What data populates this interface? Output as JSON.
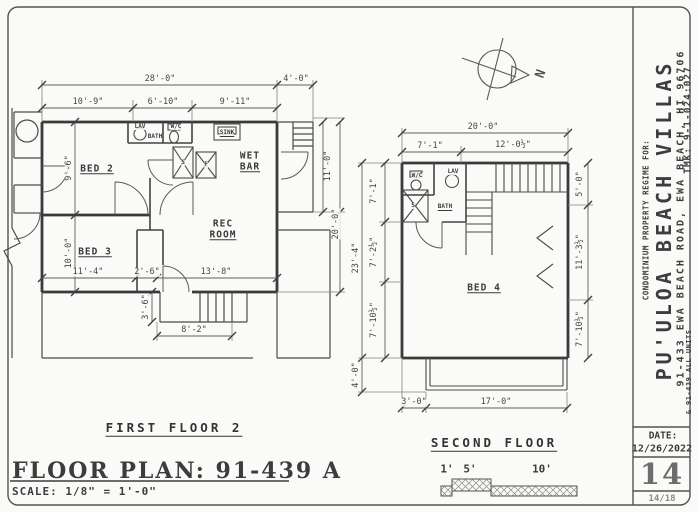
{
  "sheet": {
    "title_block": {
      "regime_line": "CONDOMINIUM PROPERTY REGIME FOR:",
      "project_name": "PU'ULOA BEACH VILLAS",
      "address": "91-433 EWA BEACH ROAD, EWA BEACH, HI 96706",
      "units_line": "& 91-439 ALL UNITS",
      "tmk": "TMK: 9-1-024:027",
      "date_label": "DATE:",
      "date_value": "12/26/2022",
      "sheet_number": "14",
      "page_fraction": "14/18"
    },
    "footer": {
      "plan_title": "FLOOR PLAN: 91-439 A",
      "scale_note": "SCALE: 1/8\" = 1'-0\""
    },
    "scale_bar": {
      "tick_1": "1'",
      "tick_5": "5'",
      "tick_10": "10'"
    },
    "north_label": "N"
  },
  "first_floor": {
    "caption": "FIRST FLOOR 2",
    "dims": {
      "overall_width": "28'-0\"",
      "right_ext": "4'-0\"",
      "top_a": "10'-9\"",
      "top_b": "6'-10\"",
      "top_c": "9'-11\"",
      "bed2_depth": "9'-6\"",
      "bed3_depth": "10'-0\"",
      "right_upper": "11'-0\"",
      "right_overall": "20'-0\"",
      "bottom_a": "11'-4\"",
      "bottom_b": "2'-6\"",
      "bottom_c": "13'-8\"",
      "stoop_depth": "3'-6\"",
      "stoop_width": "8'-2\""
    },
    "labels": {
      "bed2": "BED 2",
      "bed3": "BED 3",
      "rec_line1": "REC",
      "rec_line2": "ROOM",
      "wetbar_line1": "WET",
      "wetbar_line2": "BAR",
      "bath": "BATH",
      "lav": "LAV",
      "wc": "W/C",
      "sink": "SINK",
      "shower": "S",
      "closet_f": "F"
    }
  },
  "second_floor": {
    "caption": "SECOND FLOOR",
    "dims": {
      "overall_width": "20'-0\"",
      "top_a": "7'-1\"",
      "top_b": "12'-0½\"",
      "overall_depth": "23'-4\"",
      "left_a": "7'-1\"",
      "left_b": "7'-2½\"",
      "left_c": "7'-10½\"",
      "deck_depth": "4'-0\"",
      "right_a": "5'-0\"",
      "right_b": "11'-3½\"",
      "right_c": "7'-10½\"",
      "bottom_a": "3'-0\"",
      "bottom_b": "17'-0\""
    },
    "labels": {
      "bed4": "BED 4",
      "bath": "BATH",
      "wc": "W/C",
      "lav": "LAV",
      "shower": "S"
    }
  }
}
